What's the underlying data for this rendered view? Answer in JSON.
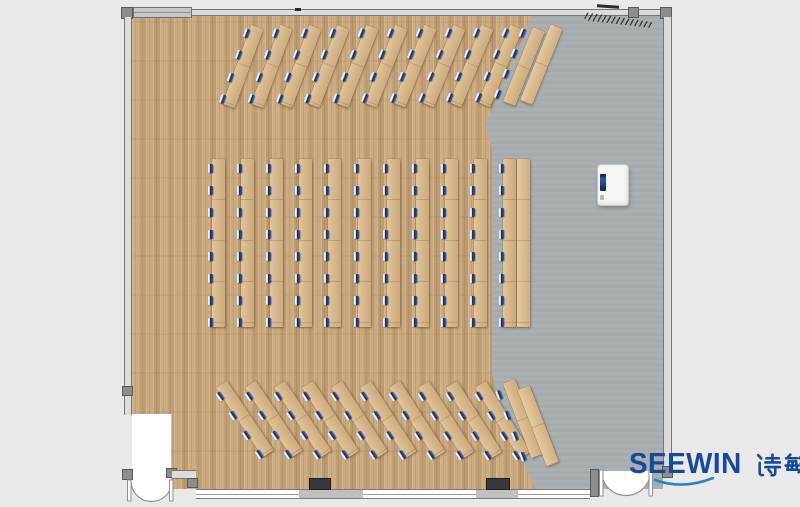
{
  "brand": {
    "latin": "SEEWIN",
    "cjk": "诗敏",
    "full": "SEEWIN 诗敏",
    "color": "#17499b",
    "swoosh_color": "#2e82c4"
  },
  "palette": {
    "page_bg": "#e9e9e9",
    "wood_floor": "#c8a67c",
    "gray_floor": "#a9aeb0",
    "desk": "#d7b78b",
    "desk_light": "#e3c69c",
    "desk_dark": "#ccab7e",
    "chair_navy": "#1c3260",
    "wall_line": "#757575",
    "equipment_screen": "#16233b"
  },
  "floorplan": {
    "description": "Top-down rendering of a lecture / training room: fanned desk rows at top and bottom, eleven vertical desk columns in the center on a wood floor, a gray presentation area on the right with a white cabinet, window wall at the bottom and two double-swing entrance doors.",
    "total_seats": 176,
    "furniture_groups": [
      {
        "name": "top-arc-desk",
        "kind": "desks",
        "count": 10,
        "seats": 4,
        "x": 246,
        "y": 26,
        "dx": 28.8,
        "dy": 0,
        "rot": 20,
        "rot_step": 0.3,
        "len": 84,
        "desk_off": 4
      },
      {
        "name": "top-right-desk",
        "kind": "desks",
        "count": 1,
        "seats": 4,
        "x": 522,
        "y": 26,
        "dx": 0,
        "dy": 0,
        "rot": 22,
        "rot_step": 0,
        "len": 80,
        "desk_off": 10
      },
      {
        "name": "top-right-counter",
        "kind": "counter",
        "count": 1,
        "seats": 0,
        "x": 549,
        "y": 27,
        "dx": 0,
        "dy": 0,
        "rot": 22,
        "rot_step": 0,
        "len": 82,
        "desk_off": 0
      },
      {
        "name": "center-column-desk",
        "kind": "desks",
        "count": 11,
        "seats": 8,
        "x": 208,
        "y": 159,
        "dx": 29.1,
        "dy": 0,
        "rot": 0,
        "rot_step": 0,
        "len": 168,
        "desk_off": 4
      },
      {
        "name": "side-counter",
        "kind": "counter",
        "count": 1,
        "seats": 0,
        "x": 517,
        "y": 159,
        "dx": 0,
        "dy": 0,
        "rot": 0,
        "rot_step": 0,
        "len": 168,
        "desk_off": 0
      },
      {
        "name": "bottom-arc-desk",
        "kind": "desks",
        "count": 10,
        "seats": 4,
        "x": 213,
        "y": 385,
        "dx": 28.8,
        "dy": 0,
        "rot": -34,
        "rot_step": 0.2,
        "len": 84,
        "desk_off": 4
      },
      {
        "name": "bottom-right-desk",
        "kind": "desks",
        "count": 1,
        "seats": 4,
        "x": 494,
        "y": 384,
        "dx": 0,
        "dy": 0,
        "rot": -21,
        "rot_step": 0,
        "len": 80,
        "desk_off": 10
      },
      {
        "name": "bottom-right-counter",
        "kind": "counter",
        "count": 1,
        "seats": 0,
        "x": 518,
        "y": 387,
        "dx": 0,
        "dy": 0,
        "rot": -21,
        "rot_step": 0,
        "len": 82,
        "desk_off": 0
      }
    ],
    "equipment": {
      "name": "white-cabinet",
      "x": 597,
      "y": 164,
      "width": 30,
      "height": 40
    },
    "doors": [
      {
        "name": "entrance-bottom-left",
        "type": "double-swing"
      },
      {
        "name": "entrance-bottom-right",
        "type": "double-swing"
      }
    ],
    "zones": [
      {
        "name": "wood-floor-seating-area"
      },
      {
        "name": "gray-presentation-area"
      }
    ]
  }
}
